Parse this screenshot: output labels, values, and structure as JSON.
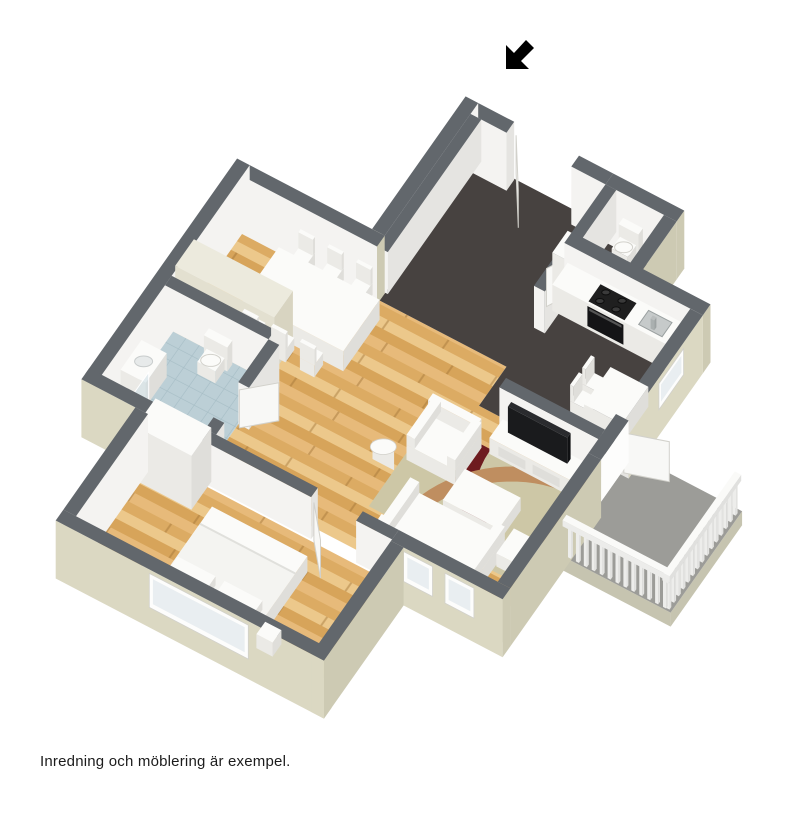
{
  "caption": "Inredning och möblering är exempel.",
  "icons": {
    "entrance_arrow": "arrow-pointing-southwest"
  },
  "palette": {
    "background": "#ffffff",
    "caption_color": "#1c1c1c",
    "arrow": "#000000",
    "wall_top": "#62676c",
    "wall_inner": "#f4f3f1",
    "wall_inner_shade": "#e5e4e1",
    "wall_outer": "#dbd8c2",
    "wall_outer_shade": "#cdcab3",
    "floor_wood": "#e2b26c",
    "wood_row1": "#e7ba7a",
    "wood_row2": "#dcab63",
    "wood_row3": "#ecc88b",
    "wood_row4": "#d7a45a",
    "wood_seam": "rgba(160,115,55,0.45)",
    "floor_dark": "#474240",
    "floor_tile": "#bccfd6",
    "tile_line": "#a6bdc5",
    "floor_balcony": "#9c9c98",
    "slab_side": "#c6c4b0",
    "furniture_top": "#fbfbf9",
    "furniture_side": "#ebeae6",
    "furniture_side_dark": "#dfdeda",
    "cream_top": "#eceadd",
    "cream_side": "#e3e0d0",
    "cream_side_dark": "#d8d4c1",
    "rug_base": "#cdc7a6",
    "rug_red": "#6e1b1f",
    "rug_tan": "#bf8e60",
    "tv_black": "#1a1b1d",
    "stove_black": "#1f1f1f",
    "oven_black": "#141416",
    "burner": "#3a3a3a",
    "sink_steel": "#c6caca",
    "sink_edge": "#9aa0a0",
    "glass": "rgba(205,222,230,0.55)",
    "window_frame": "#fdfdfc",
    "window_glass": "#e9eef1",
    "door_leaf": "#f8f8f6",
    "door_edge": "#d2d1cb"
  }
}
